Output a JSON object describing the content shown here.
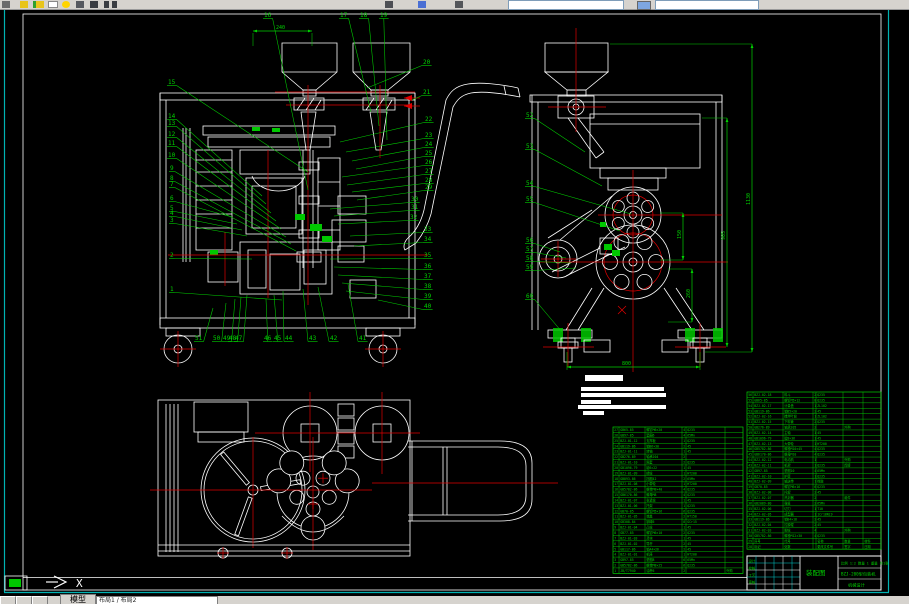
{
  "app": {
    "toolbar": {
      "icons": [
        "new-icon",
        "open-icon",
        "save-icon",
        "print-icon",
        "preview-icon",
        "cut-icon",
        "copy-icon",
        "paste-icon",
        "undo-icon",
        "redo-icon",
        "pan-icon",
        "zoom-icon",
        "properties-icon",
        "layer-control-combo",
        "color-control-combo",
        "linetype-combo"
      ],
      "layer_combo_value": "",
      "color_combo_value": ""
    },
    "statusbar": {
      "model_tab": "模型",
      "layouts_text": "布局1 / 布局2",
      "nav_buttons": [
        "first-tab",
        "prev-tab",
        "next-tab"
      ]
    }
  },
  "drawing": {
    "colors": {
      "line": "#ffffff",
      "center": "#e00000",
      "annotation": "#00d200",
      "border": "#00b2b2"
    },
    "ucs": {
      "axis_label": "X"
    },
    "dim_defaults": {
      "color": "#00d200"
    },
    "callouts": {
      "front_top": [
        {
          "n": "16",
          "x": 264,
          "y": 17,
          "tx": 308,
          "ty": 190
        },
        {
          "n": "17",
          "x": 340,
          "y": 17,
          "tx": 371,
          "ty": 112
        },
        {
          "n": "18",
          "x": 360,
          "y": 17,
          "tx": 379,
          "ty": 126
        },
        {
          "n": "19",
          "x": 380,
          "y": 17,
          "tx": 387,
          "ty": 140
        }
      ],
      "front_left": [
        {
          "n": "15",
          "x": 168,
          "y": 84,
          "tx": 308,
          "ty": 172
        },
        {
          "n": "14",
          "x": 168,
          "y": 118,
          "tx": 262,
          "ty": 196
        },
        {
          "n": "13",
          "x": 168,
          "y": 125,
          "tx": 266,
          "ty": 204
        },
        {
          "n": "12",
          "x": 168,
          "y": 136,
          "tx": 271,
          "ty": 213
        },
        {
          "n": "11",
          "x": 168,
          "y": 145,
          "tx": 276,
          "ty": 221
        },
        {
          "n": "10",
          "x": 168,
          "y": 157,
          "tx": 281,
          "ty": 229
        },
        {
          "n": "9",
          "x": 170,
          "y": 170,
          "tx": 286,
          "ty": 237
        },
        {
          "n": "8",
          "x": 170,
          "y": 180,
          "tx": 291,
          "ty": 244
        },
        {
          "n": "7",
          "x": 170,
          "y": 186,
          "tx": 296,
          "ty": 251
        },
        {
          "n": "6",
          "x": 170,
          "y": 200,
          "tx": 232,
          "ty": 217
        },
        {
          "n": "5",
          "x": 170,
          "y": 210,
          "tx": 237,
          "ty": 224
        },
        {
          "n": "4",
          "x": 170,
          "y": 215,
          "tx": 242,
          "ty": 230
        },
        {
          "n": "3",
          "x": 170,
          "y": 222,
          "tx": 247,
          "ty": 236
        },
        {
          "n": "2",
          "x": 170,
          "y": 257,
          "tx": 252,
          "ty": 259
        },
        {
          "n": "1",
          "x": 170,
          "y": 291,
          "tx": 282,
          "ty": 300
        }
      ],
      "front_right": [
        {
          "n": "20",
          "x": 423,
          "y": 64,
          "tx": 367,
          "ty": 88
        },
        {
          "n": "21",
          "x": 423,
          "y": 94,
          "tx": 412,
          "ty": 100
        },
        {
          "n": "22",
          "x": 425,
          "y": 121,
          "tx": 340,
          "ty": 142
        },
        {
          "n": "23",
          "x": 425,
          "y": 137,
          "tx": 346,
          "ty": 152
        },
        {
          "n": "24",
          "x": 425,
          "y": 146,
          "tx": 352,
          "ty": 161
        },
        {
          "n": "25",
          "x": 425,
          "y": 155,
          "tx": 356,
          "ty": 169
        },
        {
          "n": "26",
          "x": 425,
          "y": 164,
          "tx": 342,
          "ty": 177
        },
        {
          "n": "27",
          "x": 425,
          "y": 173,
          "tx": 347,
          "ty": 185
        },
        {
          "n": "28",
          "x": 425,
          "y": 182,
          "tx": 352,
          "ty": 192
        },
        {
          "n": "29",
          "x": 425,
          "y": 189,
          "tx": 357,
          "ty": 200
        },
        {
          "n": "30",
          "x": 411,
          "y": 201,
          "tx": 330,
          "ty": 209
        },
        {
          "n": "31",
          "x": 411,
          "y": 209,
          "tx": 334,
          "ty": 216
        },
        {
          "n": "32",
          "x": 410,
          "y": 219,
          "tx": 338,
          "ty": 224
        },
        {
          "n": "33",
          "x": 424,
          "y": 231,
          "tx": 350,
          "ty": 236
        },
        {
          "n": "34",
          "x": 424,
          "y": 241,
          "tx": 354,
          "ty": 246
        },
        {
          "n": "35",
          "x": 424,
          "y": 257,
          "tx": 330,
          "ty": 259
        },
        {
          "n": "36",
          "x": 424,
          "y": 268,
          "tx": 334,
          "ty": 267
        },
        {
          "n": "37",
          "x": 424,
          "y": 278,
          "tx": 338,
          "ty": 275
        },
        {
          "n": "38",
          "x": 424,
          "y": 288,
          "tx": 342,
          "ty": 283
        },
        {
          "n": "39",
          "x": 424,
          "y": 298,
          "tx": 346,
          "ty": 291
        },
        {
          "n": "40",
          "x": 424,
          "y": 308,
          "tx": 378,
          "ty": 300
        }
      ],
      "front_bottom": [
        {
          "n": "51",
          "x": 195,
          "y": 340,
          "tx": 213,
          "ty": 308
        },
        {
          "n": "50",
          "x": 213,
          "y": 340,
          "tx": 226,
          "ty": 303
        },
        {
          "n": "49",
          "x": 223,
          "y": 340,
          "tx": 235,
          "ty": 299
        },
        {
          "n": "48",
          "x": 229,
          "y": 340,
          "tx": 241,
          "ty": 297
        },
        {
          "n": "47",
          "x": 235,
          "y": 340,
          "tx": 247,
          "ty": 295
        },
        {
          "n": "46",
          "x": 264,
          "y": 340,
          "tx": 266,
          "ty": 299
        },
        {
          "n": "45",
          "x": 274,
          "y": 340,
          "tx": 274,
          "ty": 295
        },
        {
          "n": "44",
          "x": 285,
          "y": 340,
          "tx": 283,
          "ty": 291
        },
        {
          "n": "43",
          "x": 309,
          "y": 340,
          "tx": 303,
          "ty": 289
        },
        {
          "n": "42",
          "x": 330,
          "y": 340,
          "tx": 318,
          "ty": 287
        },
        {
          "n": "41",
          "x": 359,
          "y": 340,
          "tx": 348,
          "ty": 284
        }
      ],
      "side_left": [
        {
          "n": "52",
          "x": 526,
          "y": 117,
          "tx": 585,
          "ty": 152
        },
        {
          "n": "53",
          "x": 526,
          "y": 148,
          "tx": 602,
          "ty": 186
        },
        {
          "n": "54",
          "x": 526,
          "y": 185,
          "tx": 631,
          "ty": 214
        },
        {
          "n": "55",
          "x": 526,
          "y": 201,
          "tx": 620,
          "ty": 231
        },
        {
          "n": "56",
          "x": 526,
          "y": 242,
          "tx": 560,
          "ty": 252
        },
        {
          "n": "57",
          "x": 526,
          "y": 251,
          "tx": 566,
          "ty": 258
        },
        {
          "n": "58",
          "x": 526,
          "y": 260,
          "tx": 571,
          "ty": 263
        },
        {
          "n": "59",
          "x": 526,
          "y": 269,
          "tx": 576,
          "ty": 268
        },
        {
          "n": "60",
          "x": 526,
          "y": 298,
          "tx": 562,
          "ty": 332
        }
      ]
    },
    "dimensions": [
      {
        "id": "front-top-width",
        "type": "h",
        "x1": 253,
        "y1": 31,
        "x2": 312,
        "y2": 31,
        "label": "240",
        "lx": 276,
        "ly": 29,
        "ext": [
          [
            253,
            33,
            253,
            46
          ],
          [
            312,
            33,
            312,
            46
          ]
        ]
      },
      {
        "id": "side-height-outer",
        "type": "v",
        "x1": 752,
        "y1": 44,
        "x2": 752,
        "y2": 352,
        "label": "1130",
        "lx": 750,
        "ly": 205,
        "ext": [
          [
            610,
            44,
            752,
            44
          ],
          [
            705,
            352,
            752,
            352
          ]
        ]
      },
      {
        "id": "side-height-inner",
        "type": "v",
        "x1": 727,
        "y1": 118,
        "x2": 727,
        "y2": 347,
        "label": "905",
        "lx": 725,
        "ly": 240,
        "ext": [
          [
            702,
            118,
            727,
            118
          ]
        ]
      },
      {
        "id": "side-mid-1",
        "type": "v",
        "x1": 683,
        "y1": 213,
        "x2": 683,
        "y2": 260,
        "label": "150",
        "lx": 681,
        "ly": 239,
        "ext": [
          [
            660,
            213,
            683,
            213
          ],
          [
            660,
            260,
            683,
            260
          ]
        ]
      },
      {
        "id": "side-mid-2",
        "type": "v",
        "x1": 692,
        "y1": 269,
        "x2": 692,
        "y2": 322,
        "label": "260",
        "lx": 690,
        "ly": 298,
        "ext": [
          [
            668,
            269,
            692,
            269
          ],
          [
            668,
            322,
            692,
            322
          ]
        ]
      },
      {
        "id": "side-bottom-width",
        "type": "h",
        "x1": 567,
        "y1": 367,
        "x2": 700,
        "y2": 367,
        "label": "800",
        "lx": 622,
        "ly": 365,
        "ext": [
          [
            567,
            352,
            567,
            370
          ],
          [
            700,
            352,
            700,
            370
          ]
        ]
      }
    ],
    "notes": {
      "bars": [
        [
          585,
          375,
          38,
          6
        ],
        [
          581,
          387,
          83,
          4
        ],
        [
          581,
          393,
          85,
          4
        ],
        [
          581,
          400,
          30,
          4
        ],
        [
          578,
          405,
          88,
          4
        ],
        [
          583,
          411,
          21,
          4
        ]
      ]
    },
    "bom_left": {
      "x": 613,
      "y": 427,
      "row_h": 5.42,
      "cols": [
        0,
        6,
        32,
        69,
        73,
        112,
        130
      ],
      "rows": [
        [
          "27",
          "GB65-85",
          "螺钉M6×20",
          "4",
          "Q235",
          ""
        ],
        [
          "26",
          "GB97-85",
          "垫圈6",
          "4",
          "65Mn",
          ""
        ],
        [
          "25",
          "BZJ-01-12",
          "支撑板",
          "1",
          "Q235",
          ""
        ],
        [
          "24",
          "GB119-86",
          "销B6×30",
          "2",
          "45",
          ""
        ],
        [
          "23",
          "BZJ-01-11",
          "转轴",
          "1",
          "45",
          ""
        ],
        [
          "22",
          "GB276-89",
          "轴承204",
          "2",
          "",
          ""
        ],
        [
          "21",
          "BZJ-01-10",
          "隔套",
          "2",
          "Q235",
          ""
        ],
        [
          "20",
          "GB1096-79",
          "键6×22",
          "1",
          "45",
          ""
        ],
        [
          "19",
          "BZJ-01-09",
          "槽轮",
          "1",
          "HT200",
          ""
        ],
        [
          "18",
          "GB893-86",
          "挡圈42",
          "2",
          "65Mn",
          ""
        ],
        [
          "17",
          "BZJ-01-08",
          "小带轮",
          "1",
          "HT200",
          ""
        ],
        [
          "16",
          "GB5782-86",
          "螺栓M8×40",
          "4",
          "Q235",
          ""
        ],
        [
          "15",
          "GB6170-86",
          "螺母M8",
          "4",
          "Q235",
          ""
        ],
        [
          "14",
          "BZJ-01-07",
          "张紧轮",
          "1",
          "45",
          ""
        ],
        [
          "13",
          "BZJ-01-06",
          "托架",
          "1",
          "Q235",
          ""
        ],
        [
          "12",
          "GB70-85",
          "螺钉M5×16",
          "6",
          "Q235",
          ""
        ],
        [
          "11",
          "BZJ-01-05",
          "端盖",
          "2",
          "HT150",
          ""
        ],
        [
          "10",
          "GB308-84",
          "钢球6",
          "8",
          "GCr15",
          ""
        ],
        [
          "9",
          "BZJ-01-04",
          "凸轮",
          "1",
          "45",
          ""
        ],
        [
          "8",
          "GB77-85",
          "螺钉M6×10",
          "2",
          "Q235",
          ""
        ],
        [
          "7",
          "BZJ-01-03",
          "滑块",
          "1",
          "45",
          ""
        ],
        [
          "6",
          "BZJ-01-02",
          "导杆",
          "2",
          "45",
          ""
        ],
        [
          "5",
          "GB117-86",
          "销A4×26",
          "2",
          "45",
          ""
        ],
        [
          "4",
          "BZJ-01-01",
          "机座",
          "1",
          "HT200",
          ""
        ],
        [
          "3",
          "GB97-85",
          "垫圈8",
          "6",
          "65Mn",
          ""
        ],
        [
          "2",
          "GB5782-86",
          "螺栓M8×25",
          "6",
          "Q235",
          ""
        ],
        [
          "1",
          "JB/T7940",
          "油杯6",
          "2",
          "",
          "外购"
        ]
      ]
    },
    "bom_right": {
      "x": 747,
      "y": 392,
      "row_h": 5.42,
      "cols": [
        0,
        6,
        36,
        66,
        69,
        96,
        116,
        134
      ],
      "rows": [
        [
          "56",
          "BZJ-02-18",
          "料斗",
          "2",
          "Q235",
          "",
          ""
        ],
        [
          "55",
          "GB65-85",
          "螺钉M5×12",
          "8",
          "Q235",
          "",
          ""
        ],
        [
          "54",
          "BZJ-02-17",
          "计量盘",
          "1",
          "ZL102",
          "",
          ""
        ],
        [
          "53",
          "GB119-86",
          "销B5×20",
          "2",
          "45",
          "",
          ""
        ],
        [
          "52",
          "BZJ-02-16",
          "搅拌叶轮",
          "1",
          "ZL102",
          "",
          ""
        ],
        [
          "51",
          "BZJ-02-15",
          "下料管",
          "2",
          "Q235",
          "",
          ""
        ],
        [
          "50",
          "GB276-89",
          "轴承205",
          "2",
          "",
          "外购",
          ""
        ],
        [
          "49",
          "BZJ-02-14",
          "主轴",
          "1",
          "45",
          "",
          ""
        ],
        [
          "48",
          "GB1096-79",
          "键8×36",
          "1",
          "45",
          "",
          ""
        ],
        [
          "47",
          "BZJ-02-13",
          "大带轮",
          "1",
          "HT200",
          "",
          ""
        ],
        [
          "46",
          "GB5782-86",
          "螺栓M10×45",
          "4",
          "Q235",
          "",
          ""
        ],
        [
          "45",
          "GB6170-86",
          "螺母M10",
          "4",
          "Q235",
          "",
          ""
        ],
        [
          "44",
          "BZJ-02-12",
          "电动机",
          "1",
          "",
          "外购",
          ""
        ],
        [
          "43",
          "BZJ-02-11",
          "机架",
          "1",
          "Q235",
          "焊接",
          ""
        ],
        [
          "42",
          "GB97-85",
          "垫圈10",
          "4",
          "65Mn",
          "",
          ""
        ],
        [
          "41",
          "BZJ-02-10",
          "护罩",
          "1",
          "Q235",
          "",
          ""
        ],
        [
          "40",
          "BZJ-02-09",
          "输送带",
          "1",
          "橡胶",
          "",
          ""
        ],
        [
          "39",
          "GB70-85",
          "螺钉M6×16",
          "6",
          "Q235",
          "",
          ""
        ],
        [
          "38",
          "BZJ-02-08",
          "托辊",
          "2",
          "45",
          "",
          ""
        ],
        [
          "37",
          "BZJ-02-07",
          "热封器",
          "2",
          "",
          "组件",
          ""
        ],
        [
          "36",
          "GB2089-80",
          "弹簧",
          "2",
          "65Mn",
          "",
          ""
        ],
        [
          "35",
          "BZJ-02-06",
          "切刀",
          "1",
          "T10",
          "",
          ""
        ],
        [
          "34",
          "BZJ-02-05",
          "成型器",
          "1",
          "1Cr18Ni9",
          "",
          ""
        ],
        [
          "33",
          "GB119-86",
          "销B4×18",
          "2",
          "45",
          "",
          ""
        ],
        [
          "32",
          "BZJ-02-04",
          "拉膜辊",
          "2",
          "45",
          "",
          ""
        ],
        [
          "31",
          "BZJ-02-03",
          "脚轮",
          "4",
          "",
          "外购",
          ""
        ],
        [
          "30",
          "GB5782-86",
          "螺栓M12×30",
          "4",
          "Q235",
          "",
          ""
        ],
        [
          "29",
          "序号",
          "代号",
          "",
          "名称",
          "数量",
          "材料"
        ],
        [
          "28",
          "标记",
          "处数",
          "",
          "更改文件号",
          "签字",
          "日期"
        ]
      ]
    },
    "title_block": {
      "drawing_title": "装配图",
      "model_text": "BZJ-200型包装机",
      "sheet_text": "机械设计",
      "scale_row": [
        "比例",
        "1:2",
        "数量",
        "1",
        "重量",
        "共1张"
      ],
      "sig_labels": [
        "设计",
        "校核",
        "工艺",
        "审核"
      ]
    }
  }
}
